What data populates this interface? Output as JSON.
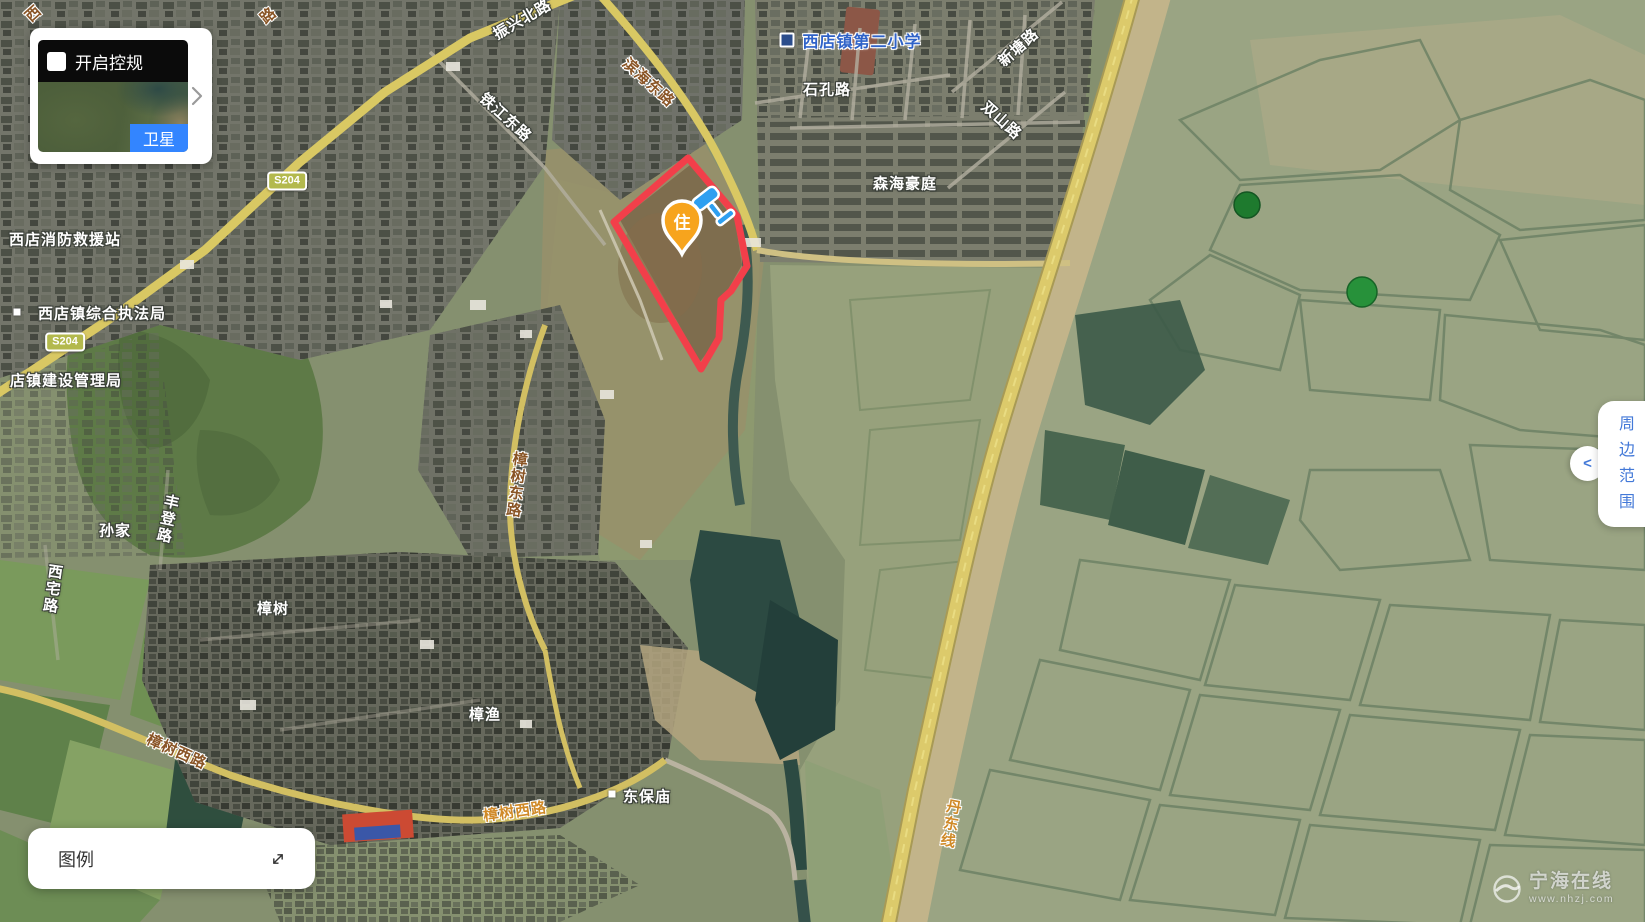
{
  "layer_control": {
    "checkbox_label": "开启控规",
    "checkbox_checked": false,
    "layer_name": "卫星"
  },
  "legend": {
    "title": "图例"
  },
  "side_panel": {
    "label": "周边范围",
    "collapse_icon": "<"
  },
  "site_marker": {
    "label": "住"
  },
  "road_badges": {
    "s204_north": "S204",
    "s204_south": "S204"
  },
  "map_labels": {
    "zhenxing_north_rd": "振兴北路",
    "binhai_east_rd": "滨海东路",
    "tiejiang_east_rd": "铁江东路",
    "shikong_rd": "石孔路",
    "xintang_rd": "新塘路",
    "shuangshan_rd": "双山路",
    "school": "西店镇第二小学",
    "senhai_estate": "森海豪庭",
    "fire_rescue_station": "西店消防救援站",
    "enforcement_bureau": "西店镇综合执法局",
    "construction_bureau": "店镇建设管理局",
    "sunjia": "孙家",
    "fengdeng_rd": "丰登路",
    "xizhai_rd": "西宅路",
    "zhangshu_village": "樟树",
    "zhangshu_east_rd": "樟树东路",
    "zhangyu": "樟渔",
    "zhangshu_west_rd_a": "樟树西路",
    "zhangshu_west_rd_b": "樟树西路",
    "dongbaomiao": "东保庙",
    "dandong_line": "丹东线",
    "corner_fragment": "西",
    "top_fragment": "路"
  },
  "watermark": {
    "name": "宁海在线",
    "url": "www.nhzj.com"
  },
  "colors": {
    "accent_blue": "#3385ff",
    "panel_text_blue": "#4379d8",
    "parcel_red": "#f23f4a",
    "marker_yellow": "#f7a41d",
    "road_badge_olive": "#b3b94d"
  }
}
